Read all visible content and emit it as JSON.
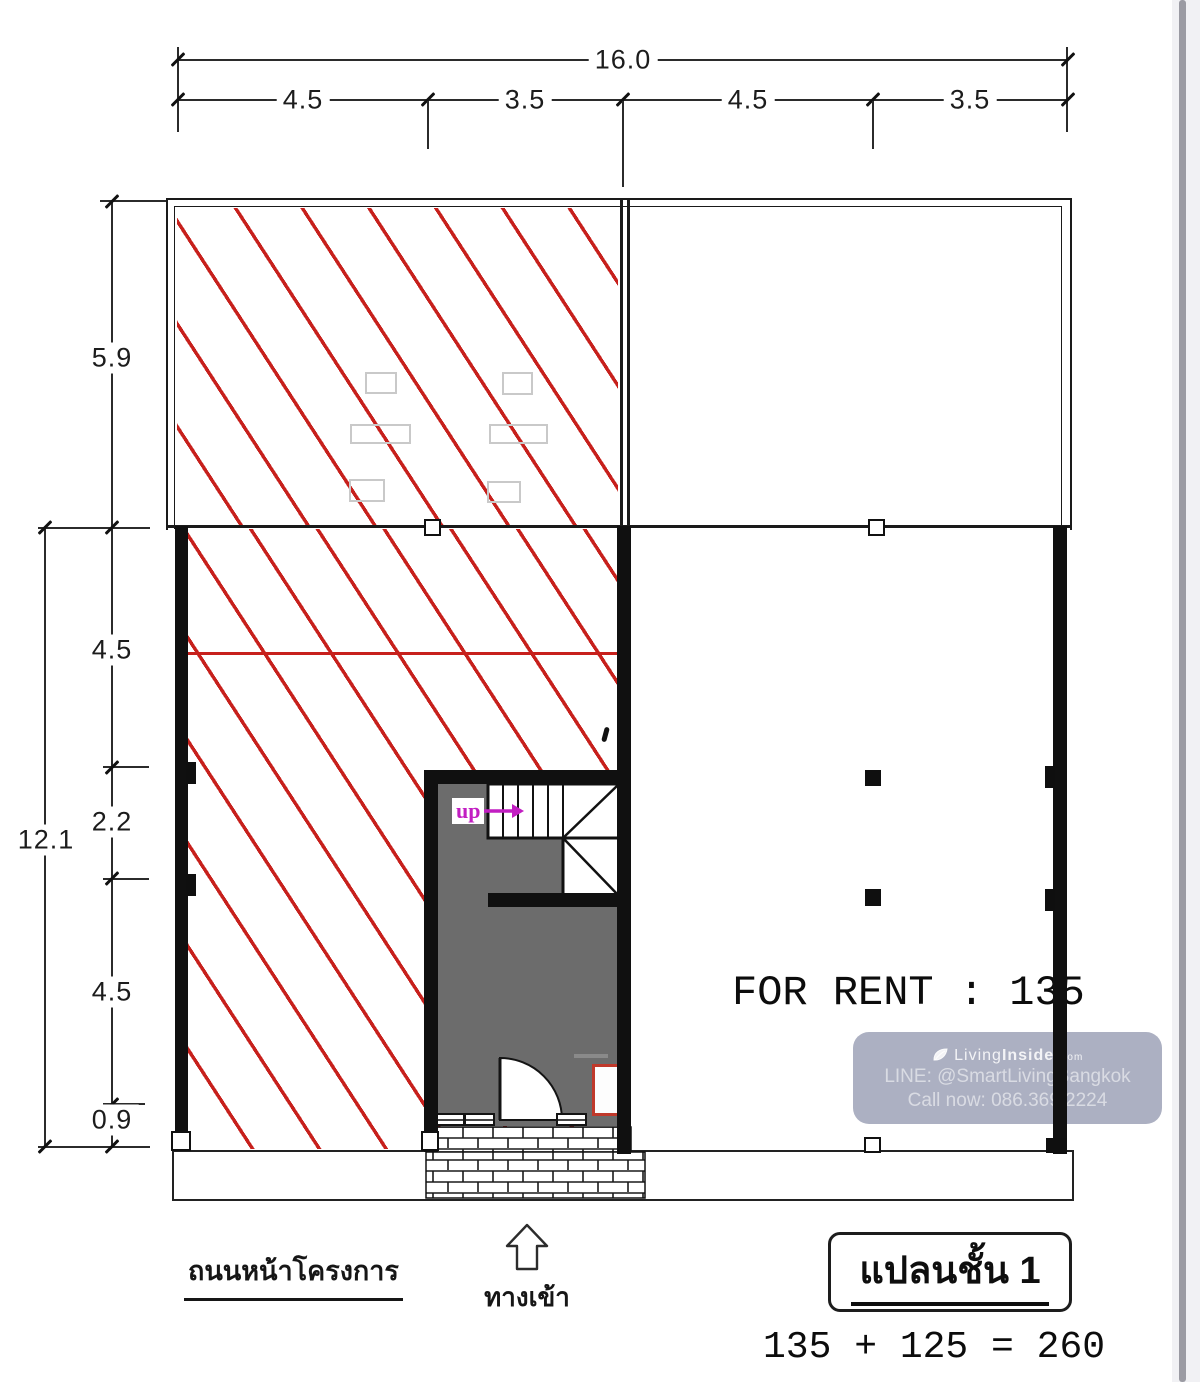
{
  "dimensions": {
    "top_total": "16.0",
    "top_segments": [
      "4.5",
      "3.5",
      "4.5",
      "3.5"
    ],
    "left_upper": "5.9",
    "left_total": "12.1",
    "left_segments": [
      "4.5",
      "2.2",
      "4.5",
      "0.9"
    ]
  },
  "plan": {
    "stair_label": "up",
    "for_rent_text": "FOR RENT : 135"
  },
  "watermark": {
    "brand_light": "Living",
    "brand_bold": "Insider",
    "brand_suffix": "com",
    "line_contact": "LINE: @SmartLivingBangkok",
    "phone": "Call now: 086.369.2224"
  },
  "footer": {
    "road_label": "ถนนหน้าโครงการ",
    "entrance_label": "ทางเข้า",
    "plan_title": "แปลนชั้น 1",
    "equation": "135 + 125 = 260"
  },
  "colors": {
    "hatch_red": "#c7201c",
    "wall_black": "#101010",
    "room_gray": "#6c6c6c",
    "watermark_bg": "#a8acbf",
    "stair_label_magenta": "#c21ec2",
    "scrollbar_thumb": "#9b9ba3"
  }
}
